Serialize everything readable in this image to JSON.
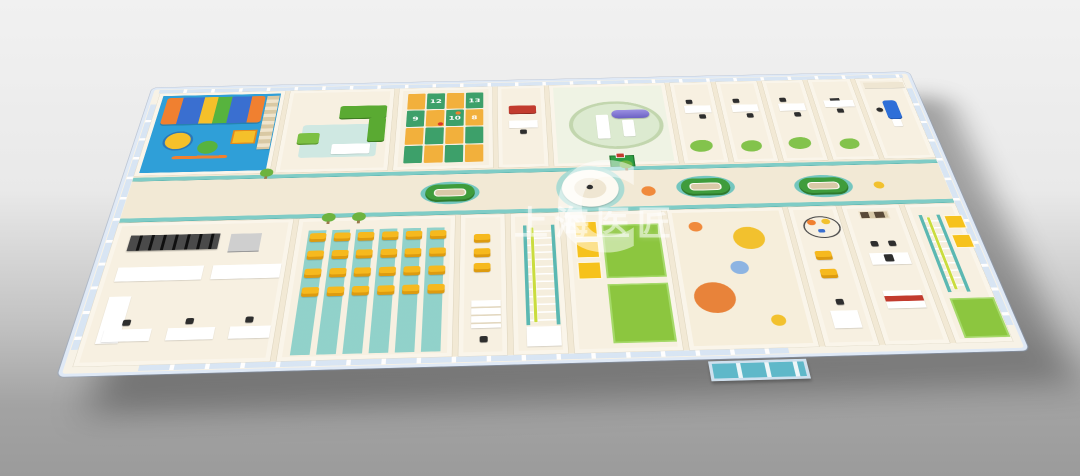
{
  "watermark": {
    "logo_letter": "C",
    "text": "上海医匠"
  },
  "palette": {
    "background_top": "#f1f1f1",
    "background_bottom": "#9b9b9b",
    "wall_cream": "#f7f2e6",
    "floor_cream": "#f2e9d5",
    "corridor_teal": "#7fccc6",
    "playground_blue": "#2f9fd8",
    "sofa_green": "#5aaa32",
    "hopscotch_green": "#3da06a",
    "hopscotch_orange": "#f2b03c",
    "waiting_chair_yellow": "#f6b91e",
    "mat_green": "#8cc63f",
    "machine_purple": "#8a7fd6",
    "dental_chair_blue": "#2e6fd8",
    "exam_couch_red": "#c23b2e",
    "window_blue": "#d6e4f4",
    "dot_orange": "#e8833a",
    "dot_yellow": "#f2c12e",
    "dot_blue": "#8db4e2"
  },
  "hopscotch": {
    "rows": 4,
    "cols": 4,
    "numbers": [
      {
        "r": 0,
        "c": 1,
        "n": "12"
      },
      {
        "r": 0,
        "c": 3,
        "n": "13"
      },
      {
        "r": 1,
        "c": 0,
        "n": "9"
      },
      {
        "r": 1,
        "c": 2,
        "n": "10"
      },
      {
        "r": 1,
        "c": 3,
        "n": "8"
      }
    ]
  },
  "entrance_dots": [
    {
      "x": 44,
      "y": 42,
      "r": 14,
      "color": "#f08a3c"
    },
    {
      "x": 148,
      "y": 78,
      "r": 32,
      "color": "#f2c12e"
    },
    {
      "x": 116,
      "y": 160,
      "r": 18,
      "color": "#8db4e2"
    },
    {
      "x": 56,
      "y": 238,
      "r": 40,
      "color": "#e8833a"
    },
    {
      "x": 168,
      "y": 300,
      "r": 14,
      "color": "#f2c12e"
    }
  ],
  "corridor_dots": [
    {
      "x": 1094,
      "y": 372,
      "r": 15,
      "color": "#f08a3c"
    },
    {
      "x": 1584,
      "y": 370,
      "r": 11,
      "color": "#f2c12e"
    }
  ],
  "waiting_chairs": {
    "rows": 4,
    "cols": 6
  },
  "small_wait_chairs": 3,
  "benches": [
    {
      "x": 624,
      "y": 336
    },
    {
      "x": 1164,
      "y": 336
    },
    {
      "x": 1414,
      "y": 342
    }
  ],
  "trees": [
    {
      "x": 414,
      "y": 416
    },
    {
      "x": 476,
      "y": 416
    },
    {
      "x": 268,
      "y": 272
    },
    {
      "x": 1040,
      "y": 272
    }
  ]
}
